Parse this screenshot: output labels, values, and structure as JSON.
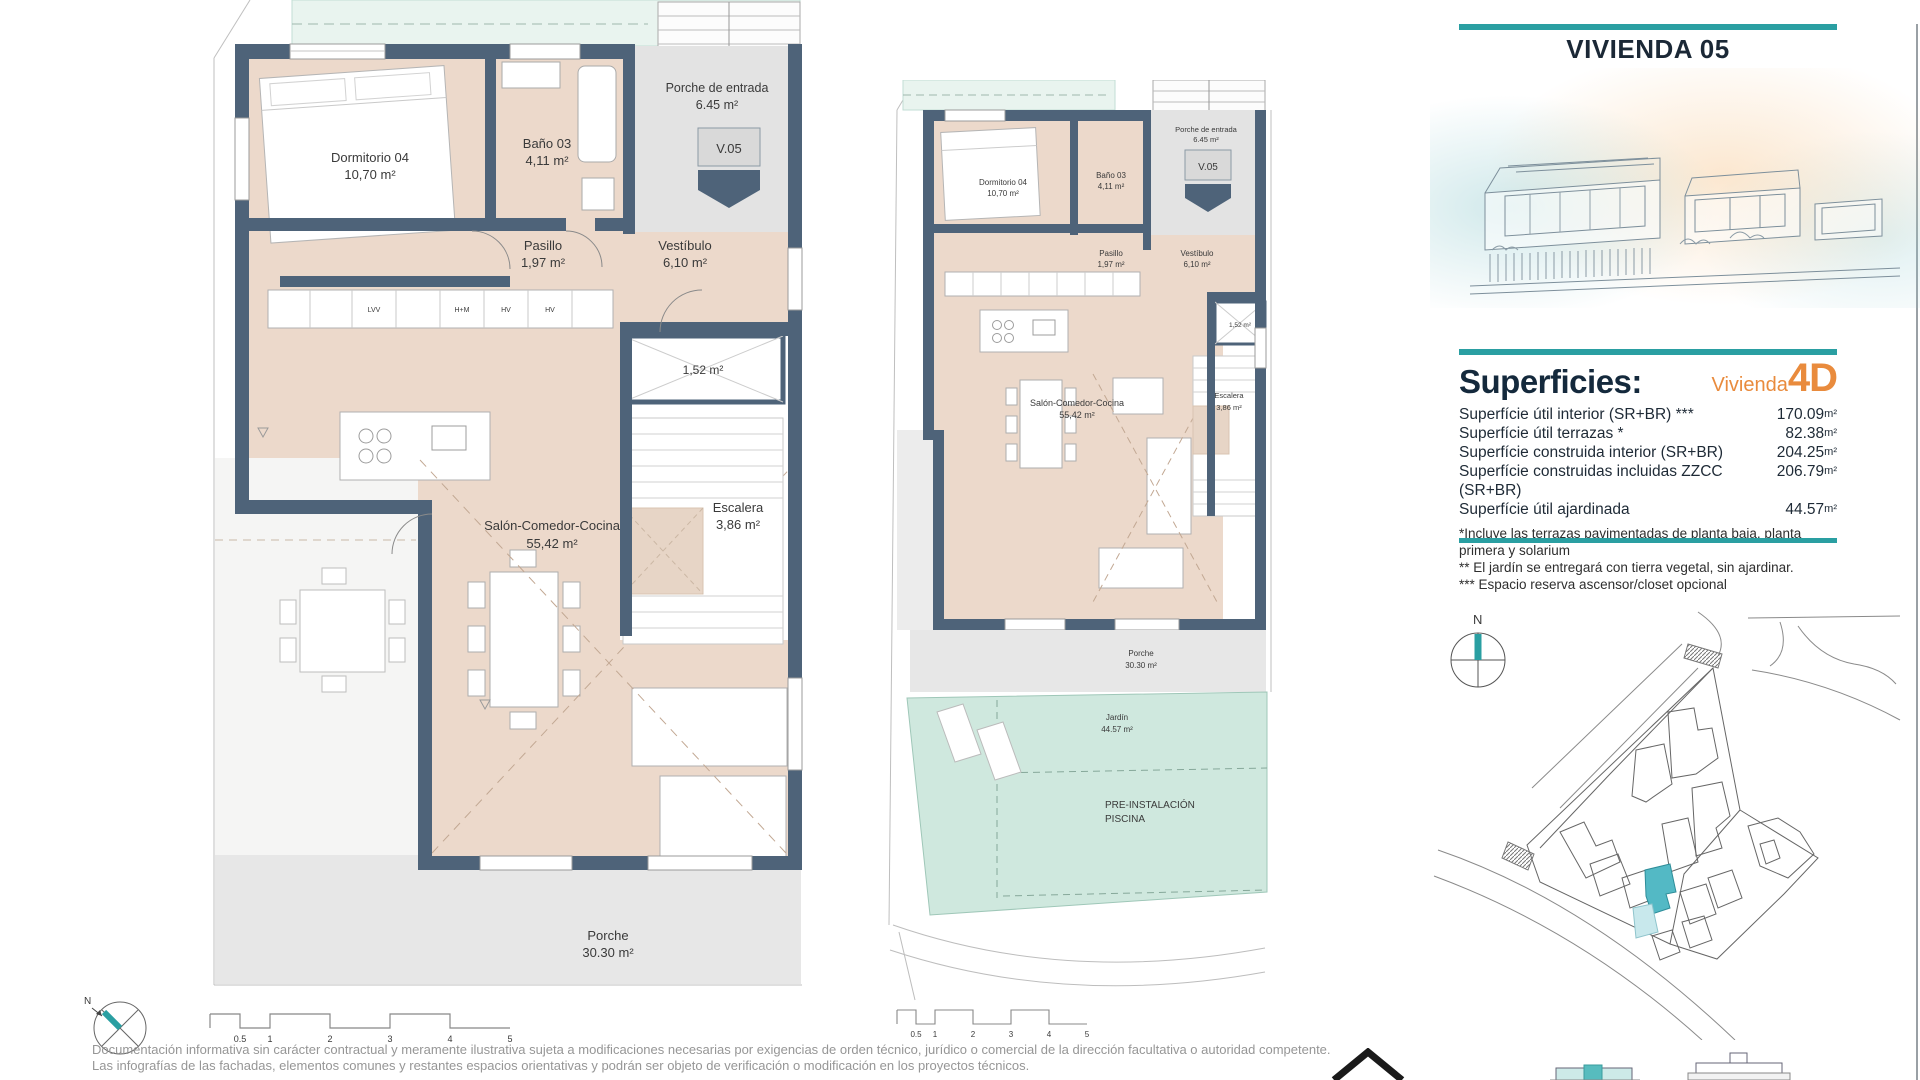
{
  "page": {
    "title": "VIVIENDA 05"
  },
  "rooms": {
    "dormitorio": {
      "name": "Dormitorio 04",
      "area": "10,70 m²"
    },
    "bano": {
      "name": "Baño 03",
      "area": "4,11 m²"
    },
    "porche_entrada": {
      "name": "Porche de entrada",
      "area": "6.45 m²"
    },
    "unit_tag": "V.05",
    "pasillo": {
      "name": "Pasillo",
      "area": "1,97 m²"
    },
    "vestibulo": {
      "name": "Vestíbulo",
      "area": "6,10 m²"
    },
    "shaft": {
      "area": "1,52 m²"
    },
    "escalera": {
      "name": "Escalera",
      "area": "3,86 m²"
    },
    "salon": {
      "name": "Salón-Comedor-Cocina",
      "area": "55,42 m²"
    },
    "porche": {
      "name": "Porche",
      "area": "30.30 m²"
    },
    "jardin": {
      "name": "Jardín",
      "area": "44.57 m²"
    },
    "pool": {
      "line1": "PRE-INSTALACIÓN",
      "line2": "PISCINA"
    },
    "kitchen_units": [
      "LVV",
      "H+M",
      "HV",
      "HV"
    ]
  },
  "panel": {
    "superficies": {
      "heading": "Superficies:",
      "vivienda_label": "Vivienda",
      "vivienda_code": "4D",
      "rows": [
        {
          "label": "Superfície útil interior (SR+BR) ***",
          "value": "170.09",
          "unit": "m²"
        },
        {
          "label": "Superfície útil terrazas *",
          "value": "82.38",
          "unit": "m²"
        },
        {
          "label": "Superfície construida interior (SR+BR)",
          "value": "204.25",
          "unit": "m²"
        },
        {
          "label": "Superfície construidas incluidas ZZCC (SR+BR)",
          "value": "206.79",
          "unit": "m²"
        },
        {
          "label": "Superfície útil ajardinada",
          "value": "44.57",
          "unit": "m²"
        }
      ],
      "footnotes": [
        "*Incluye las terrazas pavimentadas de planta baja, planta primera y solarium",
        "** El jardín se entregará con tierra vegetal, sin ajardinar.",
        "*** Espacio reserva ascensor/closet opcional"
      ]
    }
  },
  "compass": {
    "north": "N"
  },
  "scale_bar": {
    "labels": [
      "0.5",
      "1",
      "2",
      "3",
      "4",
      "5"
    ]
  },
  "disclaimer": {
    "lines": [
      "Documentación informativa sin carácter contractual y meramente ilustrativa sujeta a modificaciones necesarias por exigencias de orden técnico, jurídico o comercial de la dirección facultativa o autoridad competente.",
      "Las infografías de las fachadas, elementos comunes y restantes espacios orientativas y podrán ser objeto de verificación o modificación en los proyectos técnicos."
    ]
  },
  "colors": {
    "accent_teal": "#2a9fa2",
    "accent_orange": "#e98b3d",
    "wall": "#4e6379",
    "floor": "#ecd9cb",
    "garden": "#cfe8de",
    "porch_grey": "#e4e4e4"
  }
}
